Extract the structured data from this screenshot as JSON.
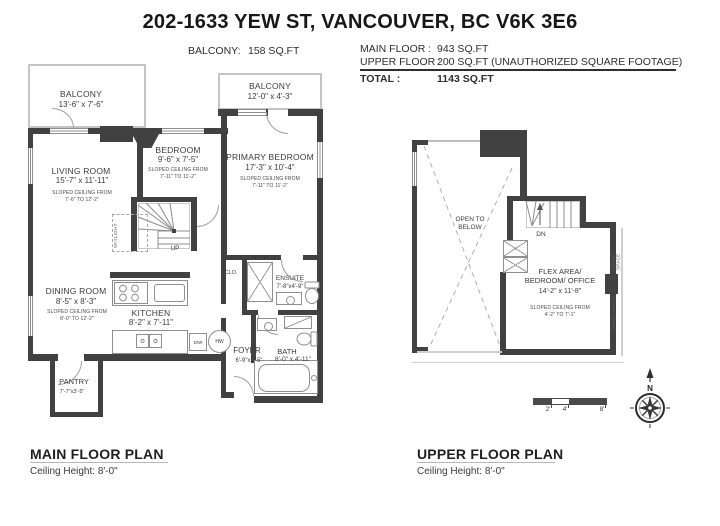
{
  "title": "202-1633 YEW ST, VANCOUVER, BC V6K 3E6",
  "summary": {
    "balcony_label": "BALCONY:",
    "balcony_value": "158 SQ.FT",
    "rows": {
      "main": {
        "label": "MAIN FLOOR :",
        "value": "943 SQ.FT"
      },
      "upper": {
        "label": "UPPER FLOOR :",
        "value": "200 SQ.FT (UNAUTHORIZED SQUARE FOOTAGE)"
      },
      "total": {
        "label": "TOTAL :",
        "value": "1143 SQ.FT"
      }
    }
  },
  "main_floor": {
    "heading": "MAIN FLOOR PLAN",
    "ceiling": "Ceiling Height: 8'-0\"",
    "balcony_left": {
      "name": "BALCONY",
      "dims": "13'-6\" x 7'-6\""
    },
    "balcony_top": {
      "name": "BALCONY",
      "dims": "12'-0\" x 4'-3\""
    },
    "living": {
      "name": "LIVING ROOM",
      "dims": "15'-7\" x 11'-11\"",
      "note1": "SLOPED CEILING FROM",
      "note2": "7'-6\" TO 12'-2\""
    },
    "bedroom": {
      "name": "BEDROOM",
      "dims": "9'-6\" x 7'-5\"",
      "note1": "SLOPED CEILING FROM",
      "note2": "7'-11\" TO 11'-2\""
    },
    "primary": {
      "name": "PRIMARY BEDROOM",
      "dims": "17'-3\" x 10'-4\"",
      "note1": "SLOPED CEILING FROM",
      "note2": "7'-11\" TO 11'-2\""
    },
    "dining": {
      "name": "DINING ROOM",
      "dims": "8'-5\" x 8'-3\"",
      "note1": "SLOPED CEILING FROM",
      "note2": "8'-0\" TO 12'-2\""
    },
    "kitchen": {
      "name": "KITCHEN",
      "dims": "8'-2\" x 7'-11\""
    },
    "ensuite": {
      "name": "ENSUITE",
      "dims": "7'-8\"x4'-9\""
    },
    "bath": {
      "name": "BATH",
      "dims": "8'-0\" x 4'-11\""
    },
    "foyer": {
      "name": "FOYER",
      "dims": "6'-9\"x3'-5\""
    },
    "pantry": {
      "name": "PANTRY",
      "dims": "7'-7\"x3'-5\""
    },
    "closet": "CLO.",
    "stairs": "UP",
    "skylight": "SKYLIGHT",
    "dishwasher": "D/W",
    "hot_water": "HW"
  },
  "upper_floor": {
    "heading": "UPPER FLOOR PLAN",
    "ceiling": "Ceiling Height: 8'-0\"",
    "open_line1": "OPEN TO",
    "open_line2": "BELOW",
    "stairs": "DN",
    "flex": {
      "name1": "FLEX AREA/",
      "name2": "BEDROOM/ OFFICE",
      "dims": "14'-2\" x 11'-8\"",
      "note1": "SLOPED CEILING FROM",
      "note2": "4'-2\" TO 7'-1\""
    },
    "crawl1": "CRAWL SPACE",
    "crawl2": "CRAWL SPACE"
  },
  "scale": {
    "t2": "2'",
    "t4": "4'",
    "t8": "8'"
  },
  "compass_n": "N",
  "colors": {
    "wall": "#414141",
    "thin_line": "#9a9a9a",
    "text": "#3c3c3c"
  }
}
